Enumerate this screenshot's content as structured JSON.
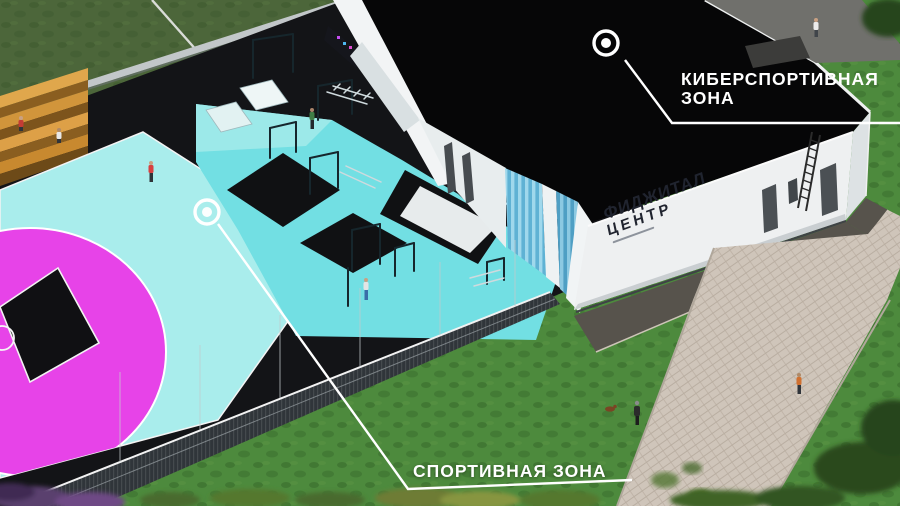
{
  "callouts": {
    "cybersport": {
      "line1": "КИБЕРСПОРТИВНАЯ",
      "line2": "ЗОНА"
    },
    "sport": {
      "label": "СПОРТИВНАЯ ЗОНА"
    }
  },
  "building_sign": {
    "line1": "ФИДЖИТАЛ",
    "line2": "ЦЕНТР"
  },
  "colors": {
    "court_pink": "#e743e8",
    "court_cyan": "#a9edec",
    "workout_cyan": "#72dfe3",
    "roof_black": "#060607",
    "grass_green": "#4d8a3d",
    "label_white": "#ffffff"
  }
}
